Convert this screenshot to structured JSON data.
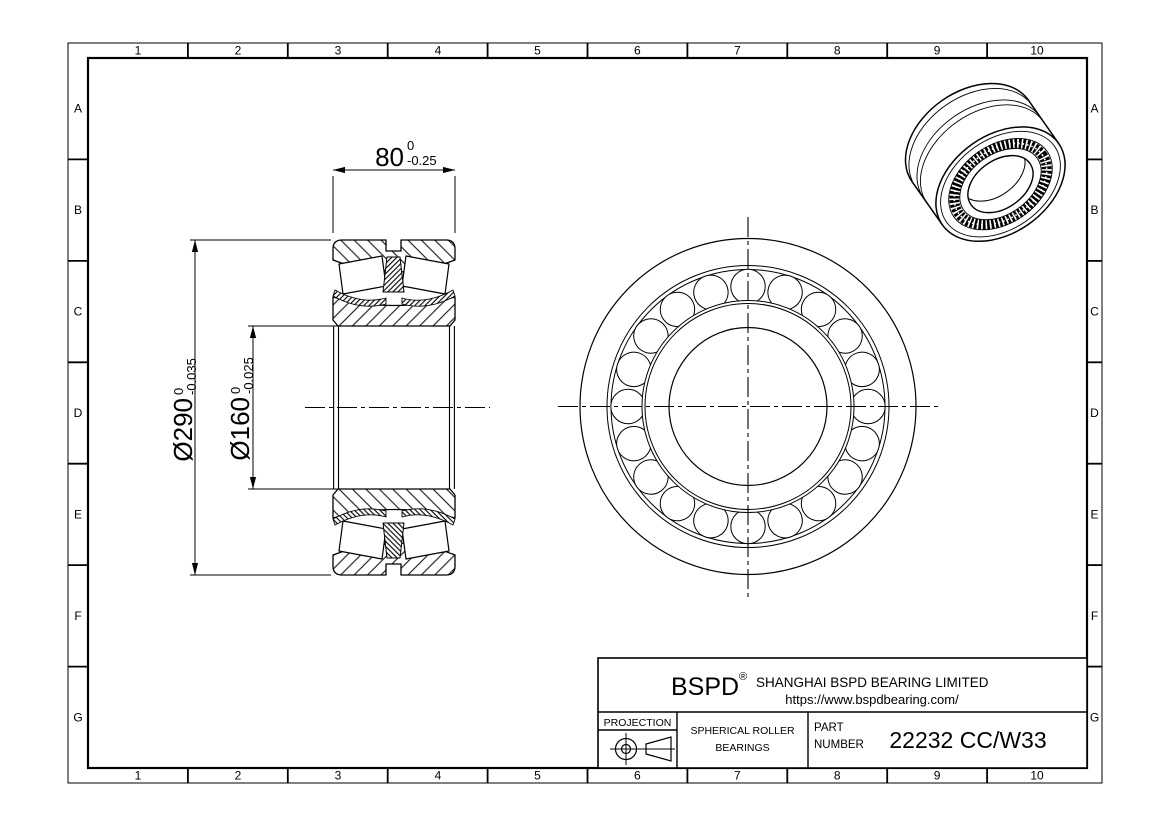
{
  "colors": {
    "line": "#000000",
    "paper": "#ffffff"
  },
  "sheet": {
    "grid": {
      "cols": [
        "1",
        "2",
        "3",
        "4",
        "5",
        "6",
        "7",
        "8",
        "9",
        "10"
      ],
      "rows": [
        "A",
        "B",
        "C",
        "D",
        "E",
        "F",
        "G"
      ]
    }
  },
  "dims": {
    "width": {
      "value": "80",
      "tol_upper": "0",
      "tol_lower": "-0.25"
    },
    "outer_diameter": {
      "value": "Ø290",
      "tol_upper": "0",
      "tol_lower": "-0.035"
    },
    "bore_diameter": {
      "value": "Ø160",
      "tol_upper": "0",
      "tol_lower": "-0.025"
    }
  },
  "title_block": {
    "brand": "BSPD",
    "brand_mark": "®",
    "company": "SHANGHAI BSPD BEARING LIMITED",
    "website": "https://www.bspdbearing.com/",
    "projection_label": "PROJECTION",
    "product_line1": "SPHERICAL ROLLER",
    "product_line2": "BEARINGS",
    "part_label_line1": "PART",
    "part_label_line2": "NUMBER",
    "part_number": "22232 CC/W33"
  }
}
